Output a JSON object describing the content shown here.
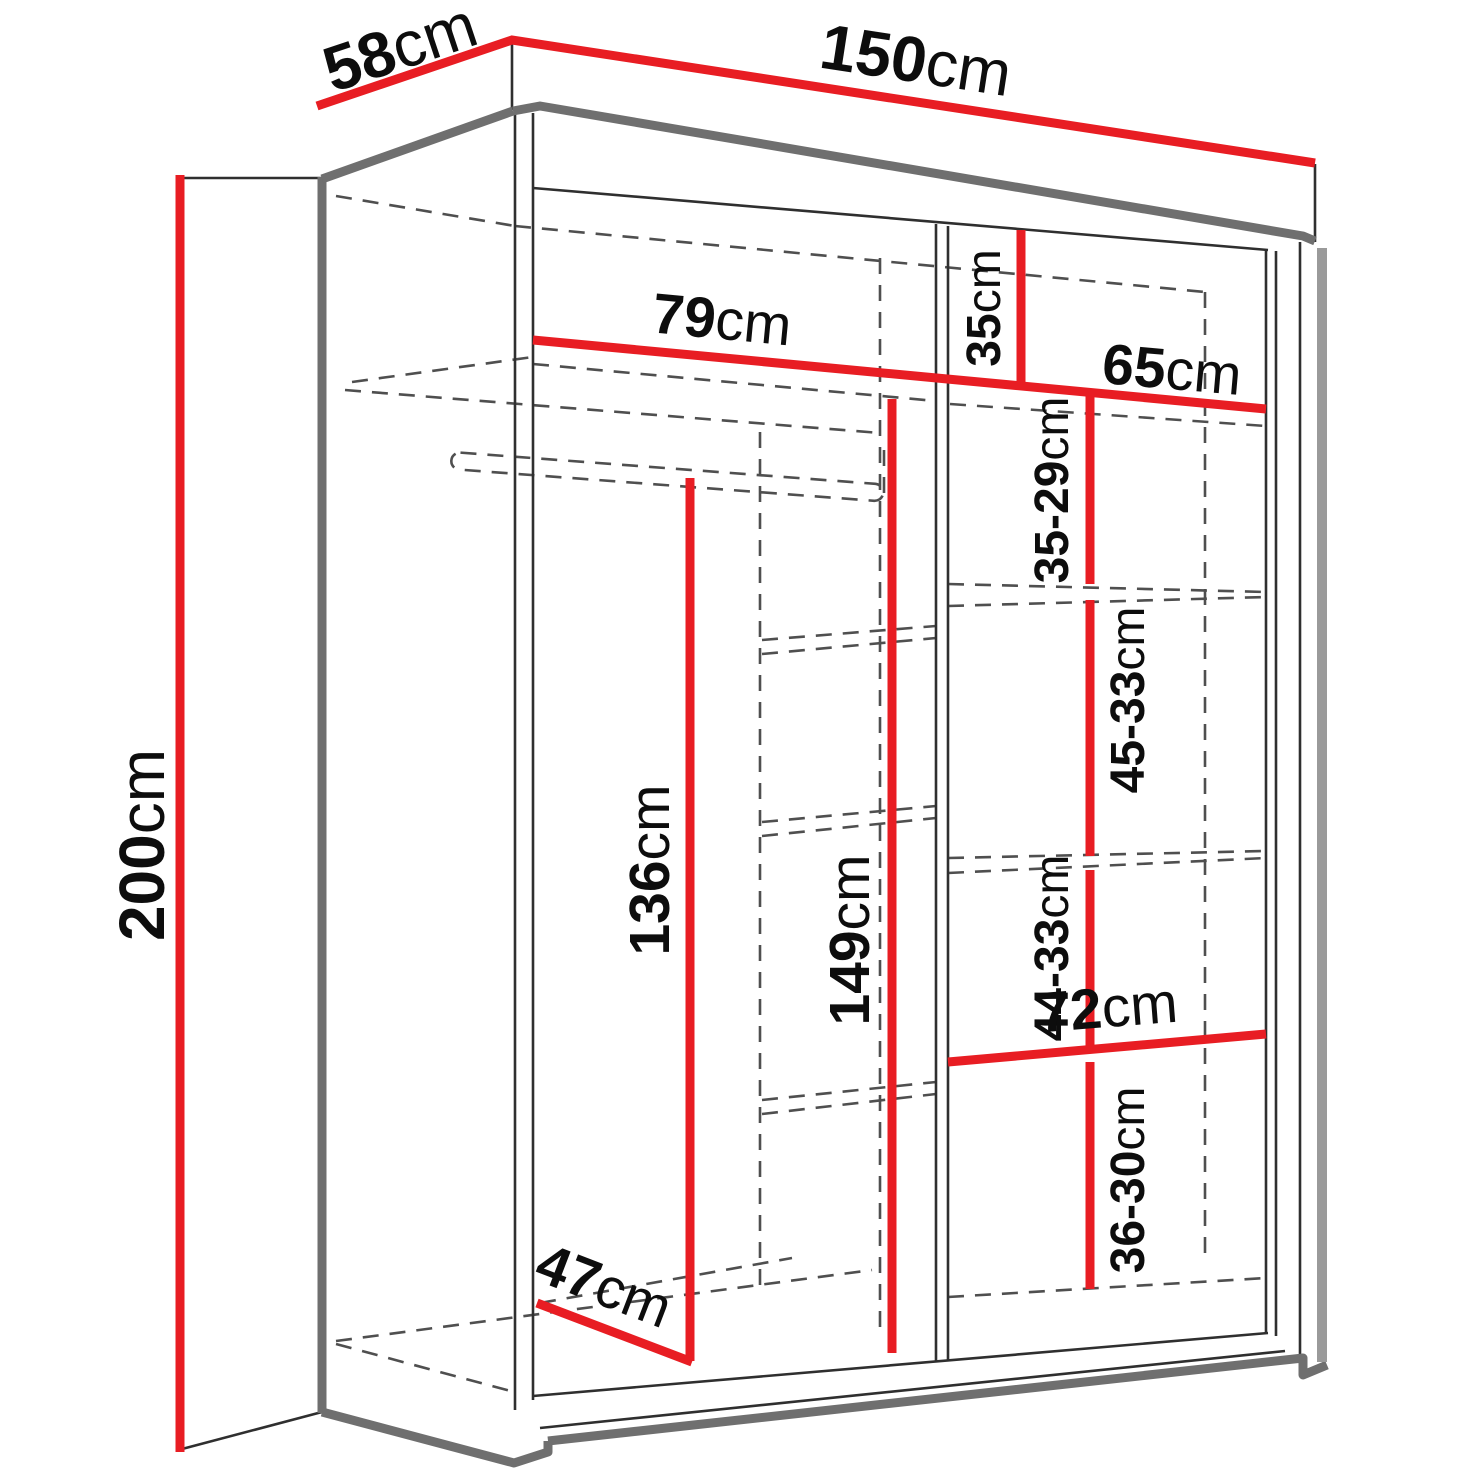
{
  "diagram": {
    "title": "sliding-door wardrobe dimension drawing",
    "unit": "cm",
    "colors": {
      "dimension_red": "#e81d23",
      "outline_thick_grey": "#6f6f6f",
      "shadow_grey": "#9a9a9a",
      "line_thin": "#2f2f2f",
      "dashed_grey": "#4f4f4f",
      "background": "#ffffff",
      "text": "#0d0d0d"
    },
    "dimensions": {
      "height": {
        "number": "200",
        "unit": "cm"
      },
      "depth": {
        "number": "58",
        "unit": "cm"
      },
      "width": {
        "number": "150",
        "unit": "cm"
      },
      "left_shelf_width": {
        "number": "79",
        "unit": "cm"
      },
      "right_top_height": {
        "number": "35",
        "unit": "cm"
      },
      "right_shelf_width": {
        "number": "65",
        "unit": "cm"
      },
      "right_gap_1": {
        "number": "35-29",
        "unit": "cm"
      },
      "right_gap_2": {
        "number": "45-33",
        "unit": "cm"
      },
      "left_hanging_height": {
        "number": "136",
        "unit": "cm"
      },
      "center_height": {
        "number": "149",
        "unit": "cm"
      },
      "right_gap_3": {
        "number": "44-33",
        "unit": "cm"
      },
      "right_lower_shelf_width": {
        "number": "72",
        "unit": "cm"
      },
      "right_gap_4": {
        "number": "36-30",
        "unit": "cm"
      },
      "floor_depth": {
        "number": "47",
        "unit": "cm"
      }
    }
  }
}
